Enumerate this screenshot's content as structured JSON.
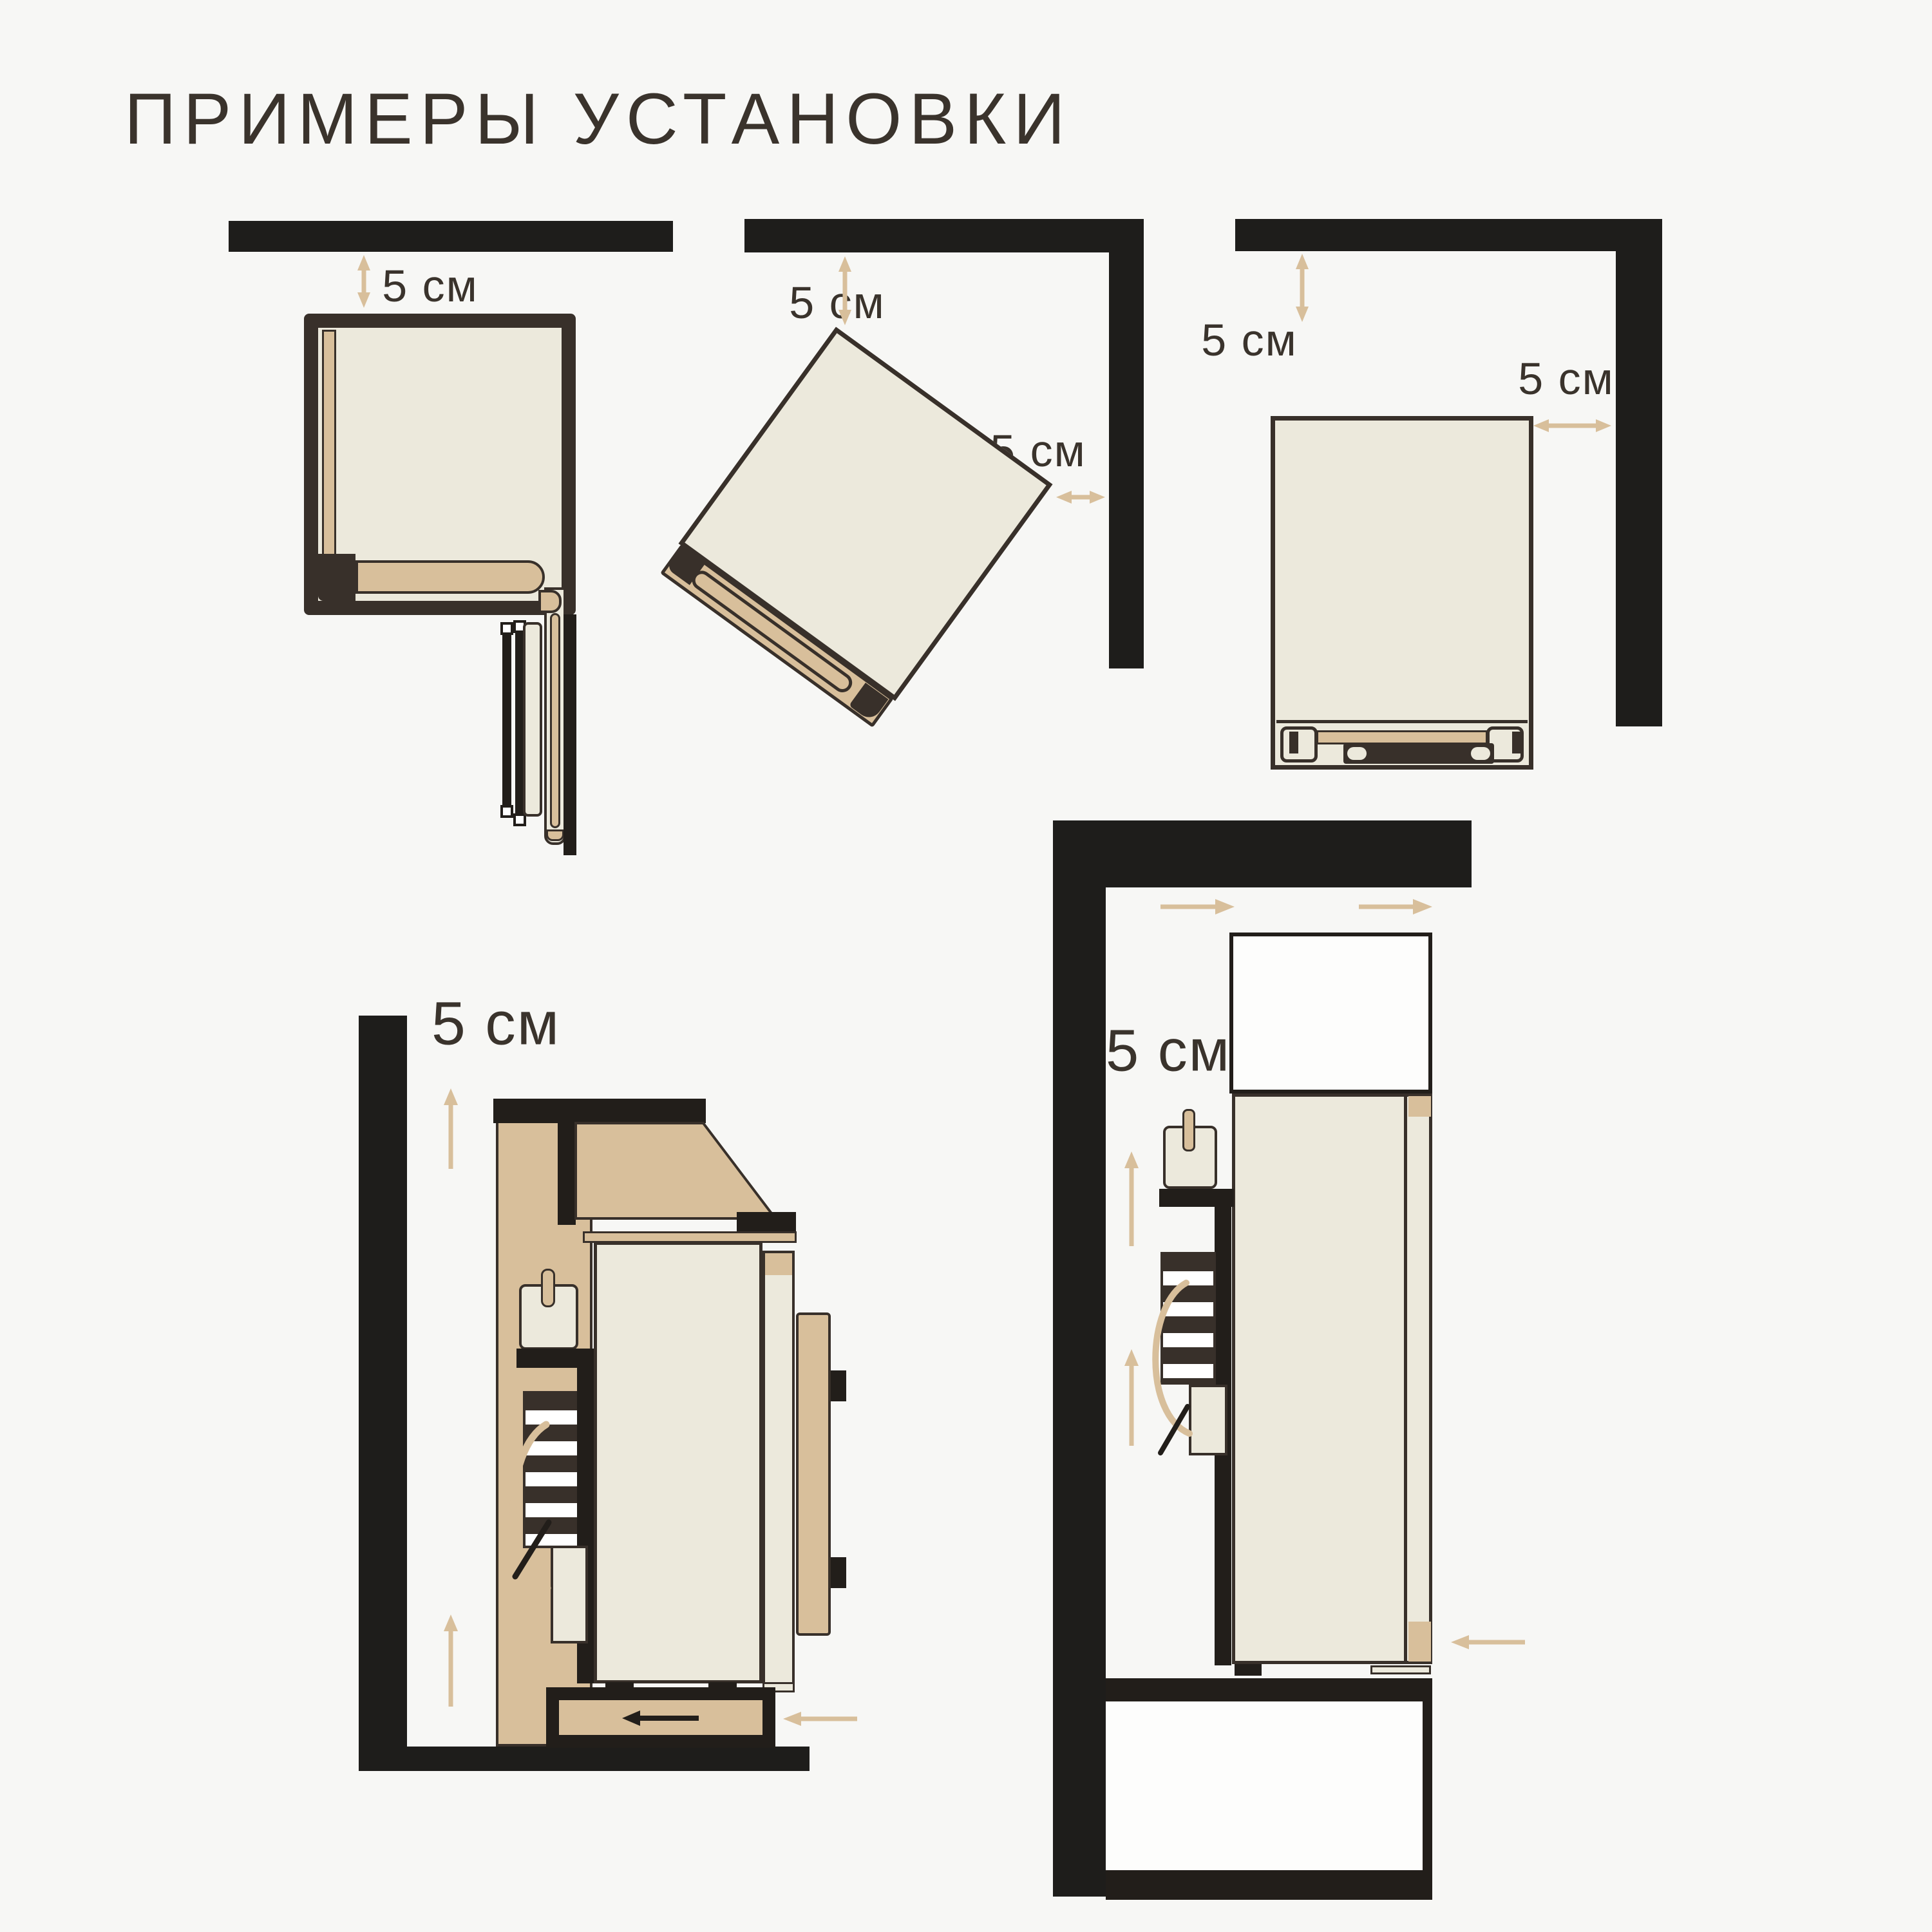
{
  "title": "ПРИМЕРЫ УСТАНОВКИ",
  "diagrams": {
    "top_left": {
      "clearance_top": "5 см"
    },
    "top_middle": {
      "clearance_top": "5 см",
      "clearance_right": "5 см"
    },
    "top_right": {
      "clearance_top": "5 см",
      "clearance_right": "5 см"
    },
    "bottom_left": {
      "clearance_side": "5 см"
    },
    "bottom_right": {
      "clearance_side": "5 см"
    }
  },
  "colors": {
    "bg": "#f7f7f5",
    "wall": "#1e1d1b",
    "ink": "#38302a",
    "ink2": "#221e1a",
    "cream": "#ece9dc",
    "tan": "#d8bf9b",
    "paper": "#fdfdfc",
    "beige": "#d8bf9b",
    "text": "#3a332c"
  }
}
